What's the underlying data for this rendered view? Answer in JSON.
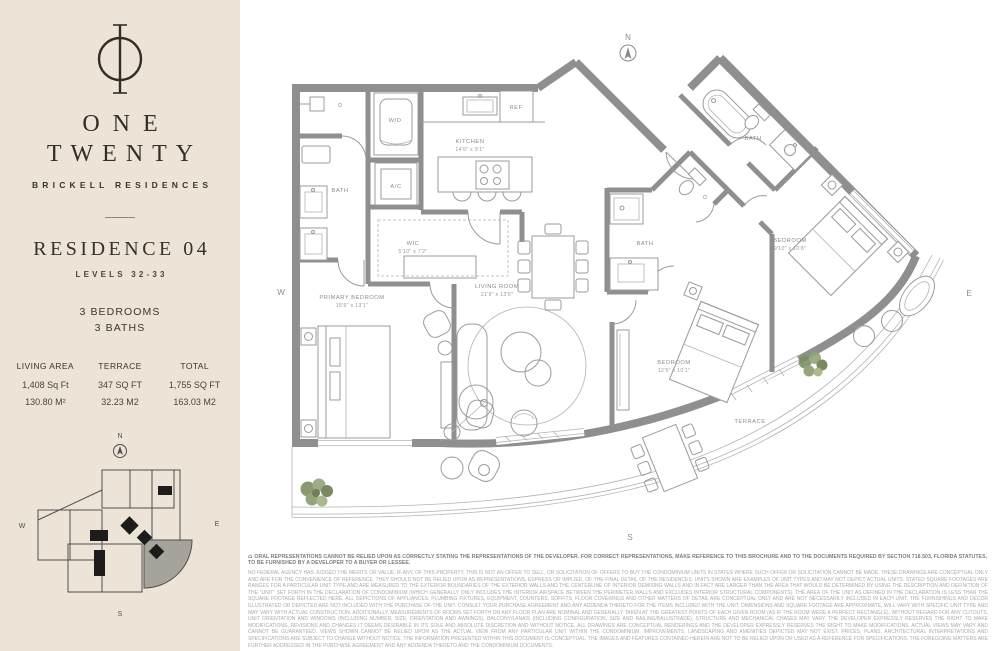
{
  "page": {
    "background": "#ffffff",
    "sidebar_background": "#ece4d7",
    "accent_ink": "#332d26",
    "wall_color": "#8f8f8f"
  },
  "sidebar": {
    "logo_icon": "one-twenty-monogram-icon",
    "brand": {
      "line1": "ONE",
      "line2": "TWENTY",
      "subtitle": "BRICKELL RESIDENCES"
    },
    "residence": {
      "title": "RESIDENCE 04",
      "levels": "LEVELS 32-33",
      "bedrooms": "3 BEDROOMS",
      "baths": "3 BATHS"
    },
    "stats": {
      "columns": [
        {
          "label": "LIVING AREA",
          "imperial": "1,408 Sq Ft",
          "metric": "130.80 M²"
        },
        {
          "label": "TERRACE",
          "imperial": "347 SQ FT",
          "metric": "32.23 M2"
        },
        {
          "label": "TOTAL",
          "imperial": "1,755 SQ FT",
          "metric": "163.03 M2"
        }
      ]
    },
    "keyplan": {
      "north": "N",
      "west": "W",
      "east": "E",
      "south": "S",
      "highlight_color": "#a6a49a"
    }
  },
  "plan": {
    "compass_north": "N",
    "west": "W",
    "east": "E",
    "south": "S",
    "rooms": {
      "kitchen": {
        "name": "KITCHEN",
        "dims": "14'6\" x 9'1\""
      },
      "wic": {
        "name": "WIC",
        "dims": "5'10\" x 7'2\""
      },
      "primary_bedroom": {
        "name": "PRIMARY BEDROOM",
        "dims": "15'6\" x 13'1\""
      },
      "living_room": {
        "name": "LIVING ROOM",
        "dims": "21'9\" x 13'6\""
      },
      "bedroom_ne": {
        "name": "BEDROOM",
        "dims": "9'10\" x 10'8\""
      },
      "bedroom_se": {
        "name": "BEDROOM",
        "dims": "12'5\" x 10'1\""
      },
      "bath_primary": {
        "name": "BATH"
      },
      "bath_center": {
        "name": "BATH"
      },
      "bath_ne": {
        "name": "BATH"
      },
      "terrace": {
        "name": "TERRACE"
      },
      "wd_closet": {
        "name": "W/D"
      },
      "ac_closet": {
        "name": "A/C"
      },
      "refrigerator": {
        "name": "REF"
      }
    }
  },
  "disclaimer": {
    "equal_housing_icon": "⌂",
    "lead": "ORAL REPRESENTATIONS CANNOT BE RELIED UPON AS CORRECTLY STATING THE REPRESENTATIONS OF THE DEVELOPER. FOR CORRECT REPRESENTATIONS, MAKE REFERENCE TO THIS BROCHURE AND TO THE DOCUMENTS REQUIRED BY SECTION 718.503, FLORIDA STATUTES, TO BE FURNISHED BY A DEVELOPER TO A BUYER OR LESSEE.",
    "body": "NO FEDERAL AGENCY HAS JUDGED THE MERITS OR VALUE, IF ANY, OF THIS PROPERTY. THIS IS NOT AN OFFER TO SELL, OR SOLICITATION OF OFFERS TO BUY THE CONDOMINIUM UNITS IN STATES WHERE SUCH OFFER OR SOLICITATION CANNOT BE MADE. THESE DRAWINGS ARE CONCEPTUAL ONLY AND ARE FOR THE CONVENIENCE OF REFERENCE. THEY SHOULD NOT BE RELIED UPON AS REPRESENTATIONS, EXPRESS OR IMPLIED, OF THE FINAL DETAIL OF THE RESIDENCES. UNITS SHOWN ARE EXAMPLES OF UNIT TYPES AND MAY NOT DEPICT ACTUAL UNITS. STATED SQUARE FOOTAGES ARE RANGES FOR A PARTICULAR UNIT TYPE AND ARE MEASURED TO THE EXTERIOR BOUNDARIES OF THE EXTERIOR WALLS AND THE CENTERLINE OF INTERIOR DEMISING WALLS AND IN FACT ARE LARGER THAN THE AREA THAT WOULD BE DETERMINED BY USING THE DESCRIPTION AND DEFINITION OF THE \"UNIT\" SET FORTH IN THE DECLARATION OF CONDOMINIUM (WHICH GENERALLY ONLY INCLUDES THE INTERIOR AIRSPACE BETWEEN THE PERIMETER WALLS AND EXCLUDES INTERIOR STRUCTURAL COMPONENTS). THE AREA OF THE UNIT AS DEFINED IN THE DECLARATION IS LESS THAN THE SQUARE FOOTAGE REFLECTED HERE. ALL DEPICTIONS OF APPLIANCES, PLUMBING FIXTURES, EQUIPMENT, COUNTERS, SOFFITS, FLOOR COVERINGS AND OTHER MATTERS OF DETAIL ARE CONCEPTUAL ONLY AND ARE NOT NECESSARILY INCLUDED IN EACH UNIT. THE FURNISHINGS AND DECOR ILLUSTRATED OR DEPICTED ARE NOT INCLUDED WITH THE PURCHASE OF THE UNIT. CONSULT YOUR PURCHASE AGREEMENT AND ANY ADDENDA THERETO FOR THE ITEMS INCLUDED WITH THE UNIT. DIMENSIONS AND SQUARE FOOTAGE ARE APPROXIMATE, WILL VARY WITH SPECIFIC UNIT TYPE AND MAY VARY WITH ACTUAL CONSTRUCTION. ADDITIONALLY, MEASUREMENTS OF ROOMS SET FORTH ON ANY FLOOR PLAN ARE NOMINAL AND GENERALLY TAKEN AT THE GREATEST POINTS OF EACH GIVEN ROOM (AS IF THE ROOM WERE A PERFECT RECTANGLE), WITHOUT REGARD FOR ANY CUTOUTS. UNIT ORIENTATION AND WINDOWS (INCLUDING NUMBER, SIZE, ORIENTATION AND AWNINGS), BALCONY/LANAIS (INCLUDING CONFIGURATION, SIZE AND RAILING/BALUSTRADE), STRUCTURE AND MECHANICAL CHASES MAY VARY. THE DEVELOPER EXPRESSLY RESERVES THE RIGHT TO MAKE MODIFICATIONS, REVISIONS AND CHANGES IT DEEMS DESIRABLE IN ITS SOLE AND ABSOLUTE DISCRETION AND WITHOUT NOTICE. ALL DRAWINGS ARE CONCEPTUAL RENDERINGS AND THE DEVELOPER EXPRESSLY RESERVES THE RIGHT TO MAKE MODIFICATIONS. ACTUAL VIEWS MAY VARY AND CANNOT BE GUARANTEED. VIEWS SHOWN CANNOT BE RELIED UPON AS THE ACTUAL VIEW FROM ANY PARTICULAR UNIT WITHIN THE CONDOMINIUM. IMPROVEMENTS, LANDSCAPING AND AMENITIES DEPICTED MAY NOT EXIST. PRICES, PLANS, ARCHITECTURAL INTERPRETATIONS AND SPECIFICATIONS ARE SUBJECT TO CHANGE WITHOUT NOTICE. THE INFORMATION PRESENTED WITHIN THIS DOCUMENT IS CONCEPTUAL. THE IMAGES AND FEATURES CONTAINED HEREIN ARE NOT TO BE RELIED UPON OR USED AS A REFERENCE FOR SPECIFICATIONS. THE FOREGOING MATTERS ARE FURTHER ADDRESSED IN THE PURCHASE AGREEMENT AND ANY ADDENDA THERETO AND THE CONDOMINIUM DOCUMENTS."
  }
}
